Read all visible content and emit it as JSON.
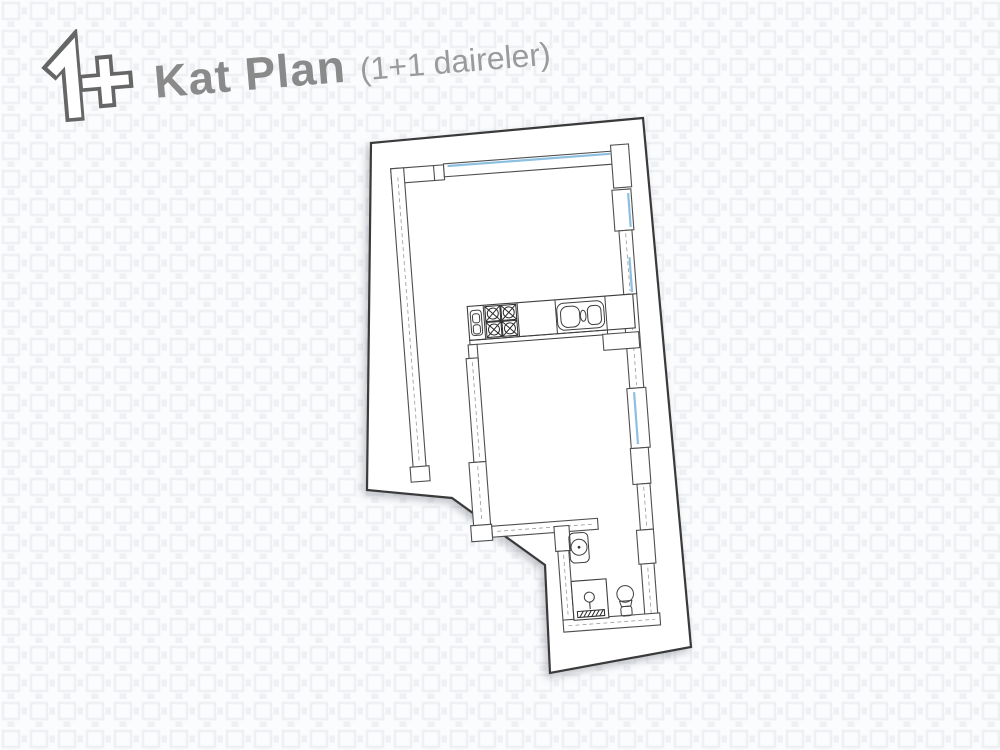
{
  "header": {
    "logo": "one-plus-floorplan-logo",
    "title": "Kat Plan",
    "subtitle": "(1+1 daireler)"
  },
  "floor_plan": {
    "description": "Hand-drawn architectural floor plan of a 1+1 apartment unit on a tilted white sheet",
    "fixtures": [
      "kitchen-counter",
      "stove-four-burners",
      "double-bowl-sink",
      "washbasin",
      "shower-tray",
      "toilet"
    ],
    "window_count": 4
  },
  "colors": {
    "background": "#fbfcfd",
    "pattern": "#eef0f4",
    "sheet": "#ffffff",
    "sheet_border": "#3a3a3a",
    "wall_line": "#4f4f4f",
    "window_blue": "#8cbfe0",
    "title_gray": "#8a8a8a",
    "subtitle_gray": "#9b9b9b",
    "logo_gray": "#666666"
  }
}
